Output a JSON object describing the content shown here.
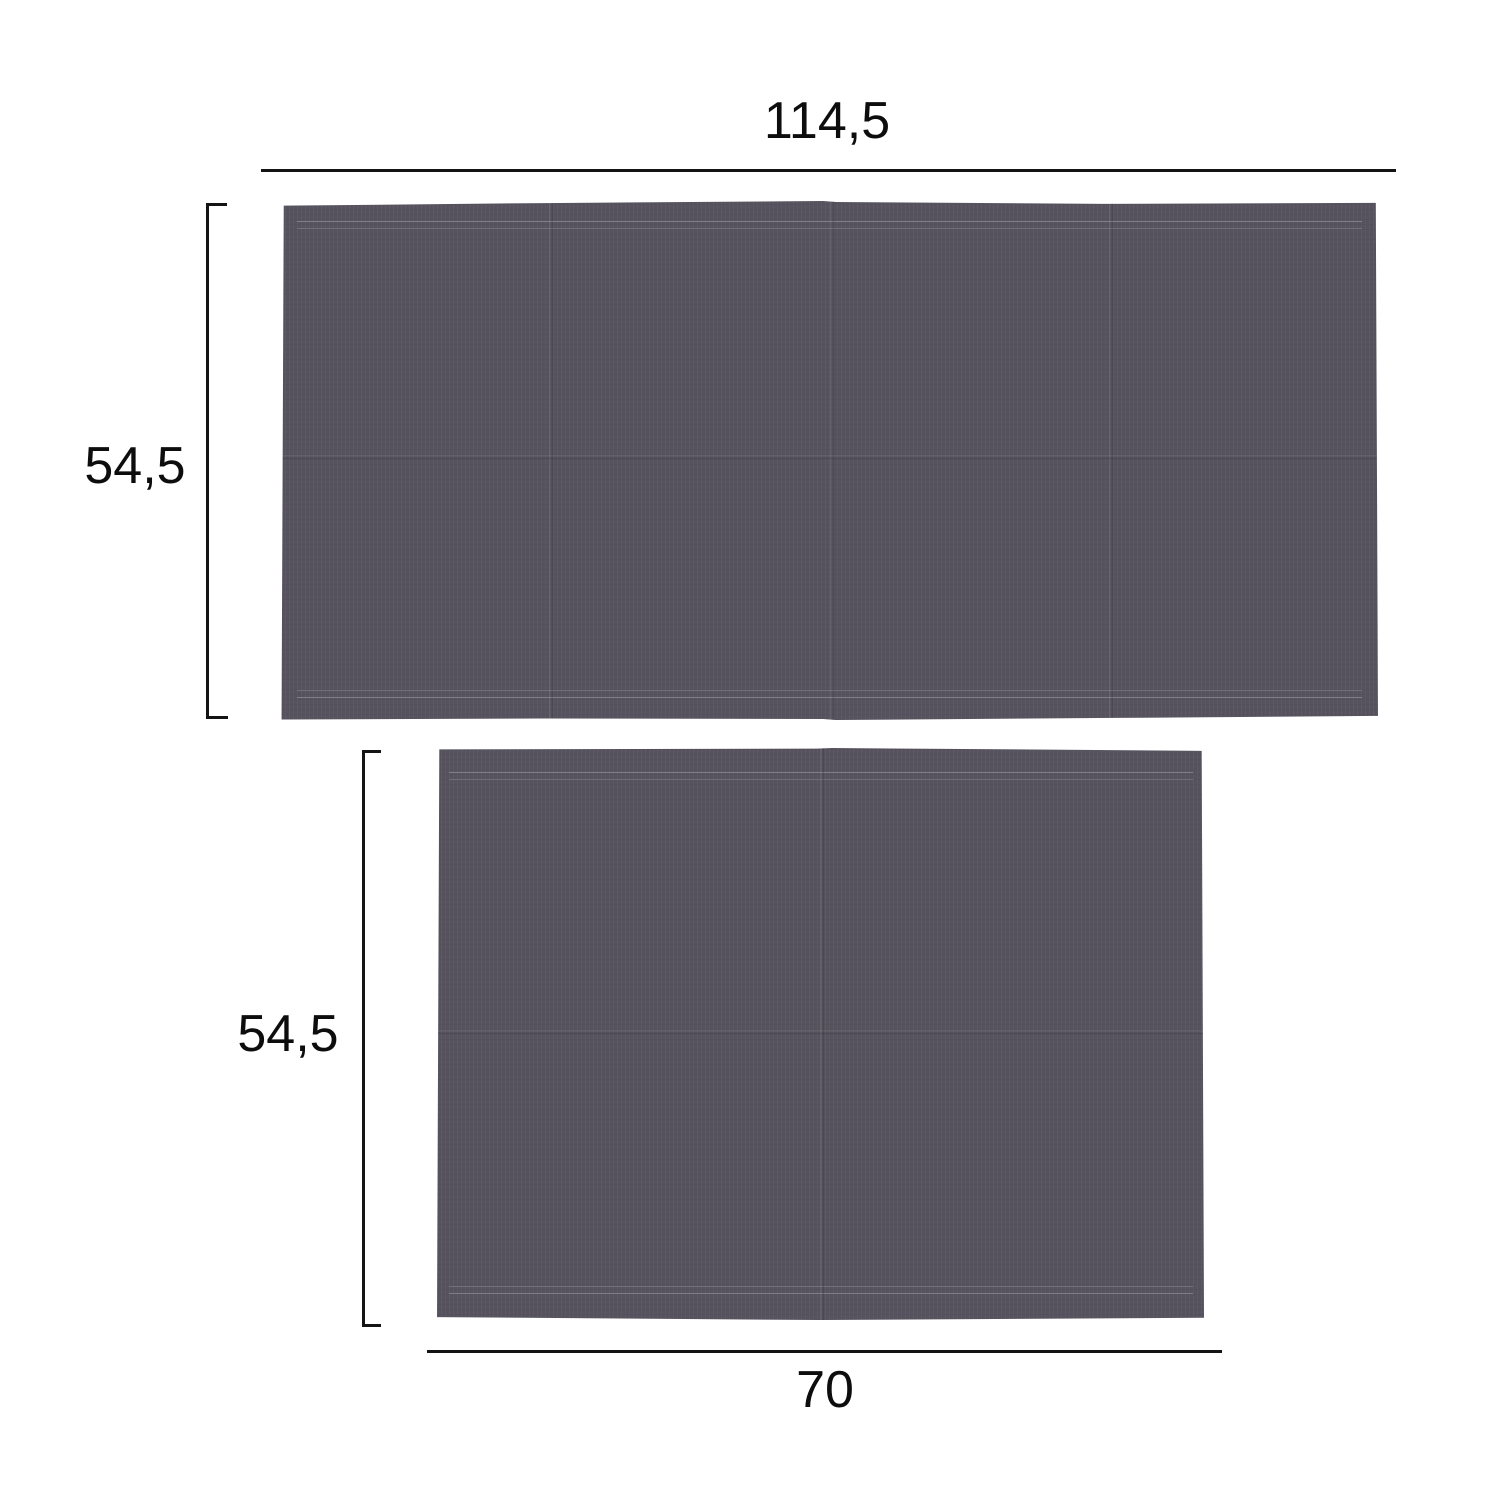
{
  "diagram": {
    "panels": [
      {
        "id": "large",
        "width_label": "114,5",
        "height_label": "54,5"
      },
      {
        "id": "small",
        "width_label": "70",
        "height_label": "54,5"
      }
    ],
    "colors": {
      "background": "#ffffff",
      "fabric": "#56535e",
      "stitch": "#a3a1ab",
      "line": "#141414",
      "text": "#0d0d0d"
    }
  }
}
